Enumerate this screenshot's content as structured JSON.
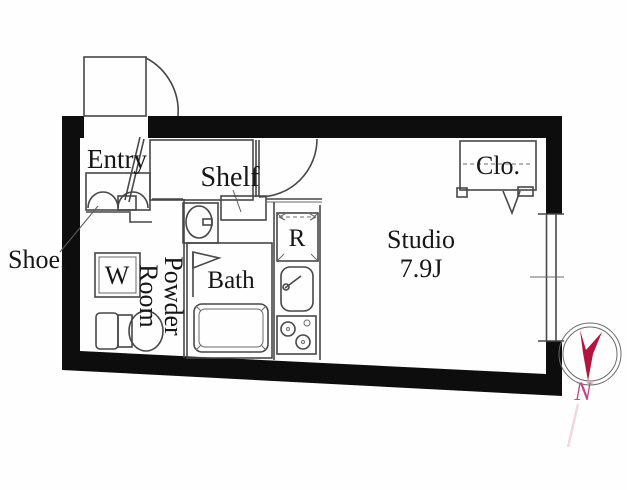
{
  "plan": {
    "type": "apartment-floor-plan",
    "labels": {
      "entry": "Entry",
      "shoe": "Shoe.",
      "shelf": "Shelf",
      "washer": "W",
      "powder_line1": "Powder",
      "powder_line2": "Room",
      "bath": "Bath",
      "fridge": "R",
      "studio_line1": "Studio",
      "studio_line2": "7.9J",
      "closet": "Clo.",
      "north": "N"
    },
    "colors": {
      "wall": "#0d0d0d",
      "line": "#474747",
      "text": "#161616",
      "compass_red": "#b2163f",
      "north_red": "#c2487f"
    }
  }
}
